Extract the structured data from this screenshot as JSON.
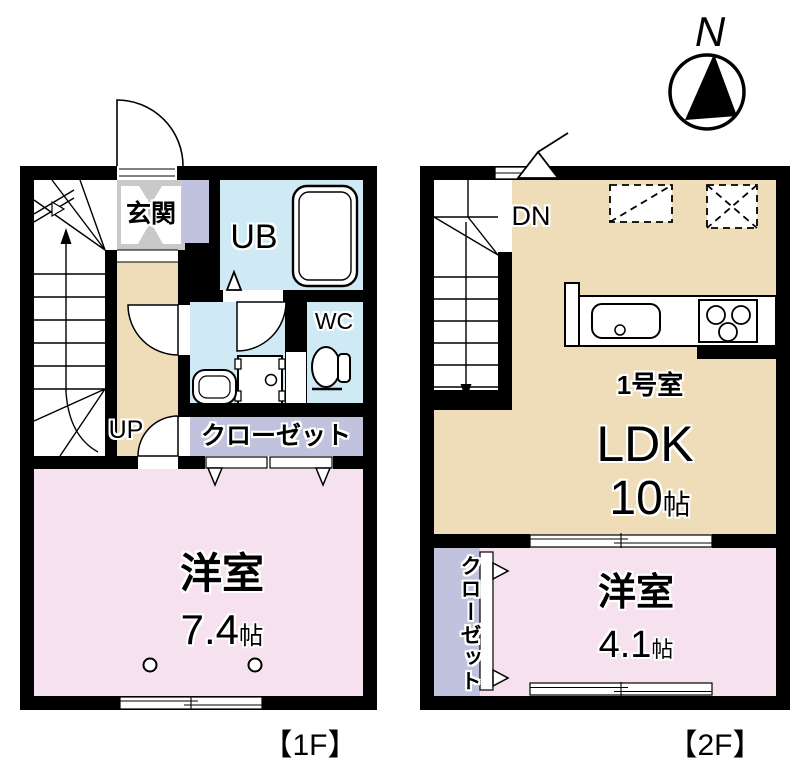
{
  "page": {
    "background": "#ffffff"
  },
  "compass": {
    "label": "N"
  },
  "colors": {
    "wall": "#000000",
    "wood_tan": "#efddb9",
    "bedroom_pink": "#f6e1ef",
    "wet_area_blue": "#cfeaf4",
    "closet_lavender": "#c1c2dd",
    "entrance_gray": "#c9c9c9"
  },
  "floor1": {
    "tag": "【1F】",
    "entrance_label": "玄関",
    "bath_label": "UB",
    "wc_label": "WC",
    "closet_label": "クローゼット",
    "stairs_label": "UP",
    "bedroom": {
      "name": "洋室",
      "size": "7.4",
      "unit": "帖"
    }
  },
  "floor2": {
    "tag": "【2F】",
    "stairs_label": "DN",
    "unit_label": "1号室",
    "ldk": {
      "name": "LDK",
      "size": "10",
      "unit": "帖"
    },
    "closet_label": "クローゼット",
    "bedroom": {
      "name": "洋室",
      "size": "4.1",
      "unit": "帖"
    }
  }
}
